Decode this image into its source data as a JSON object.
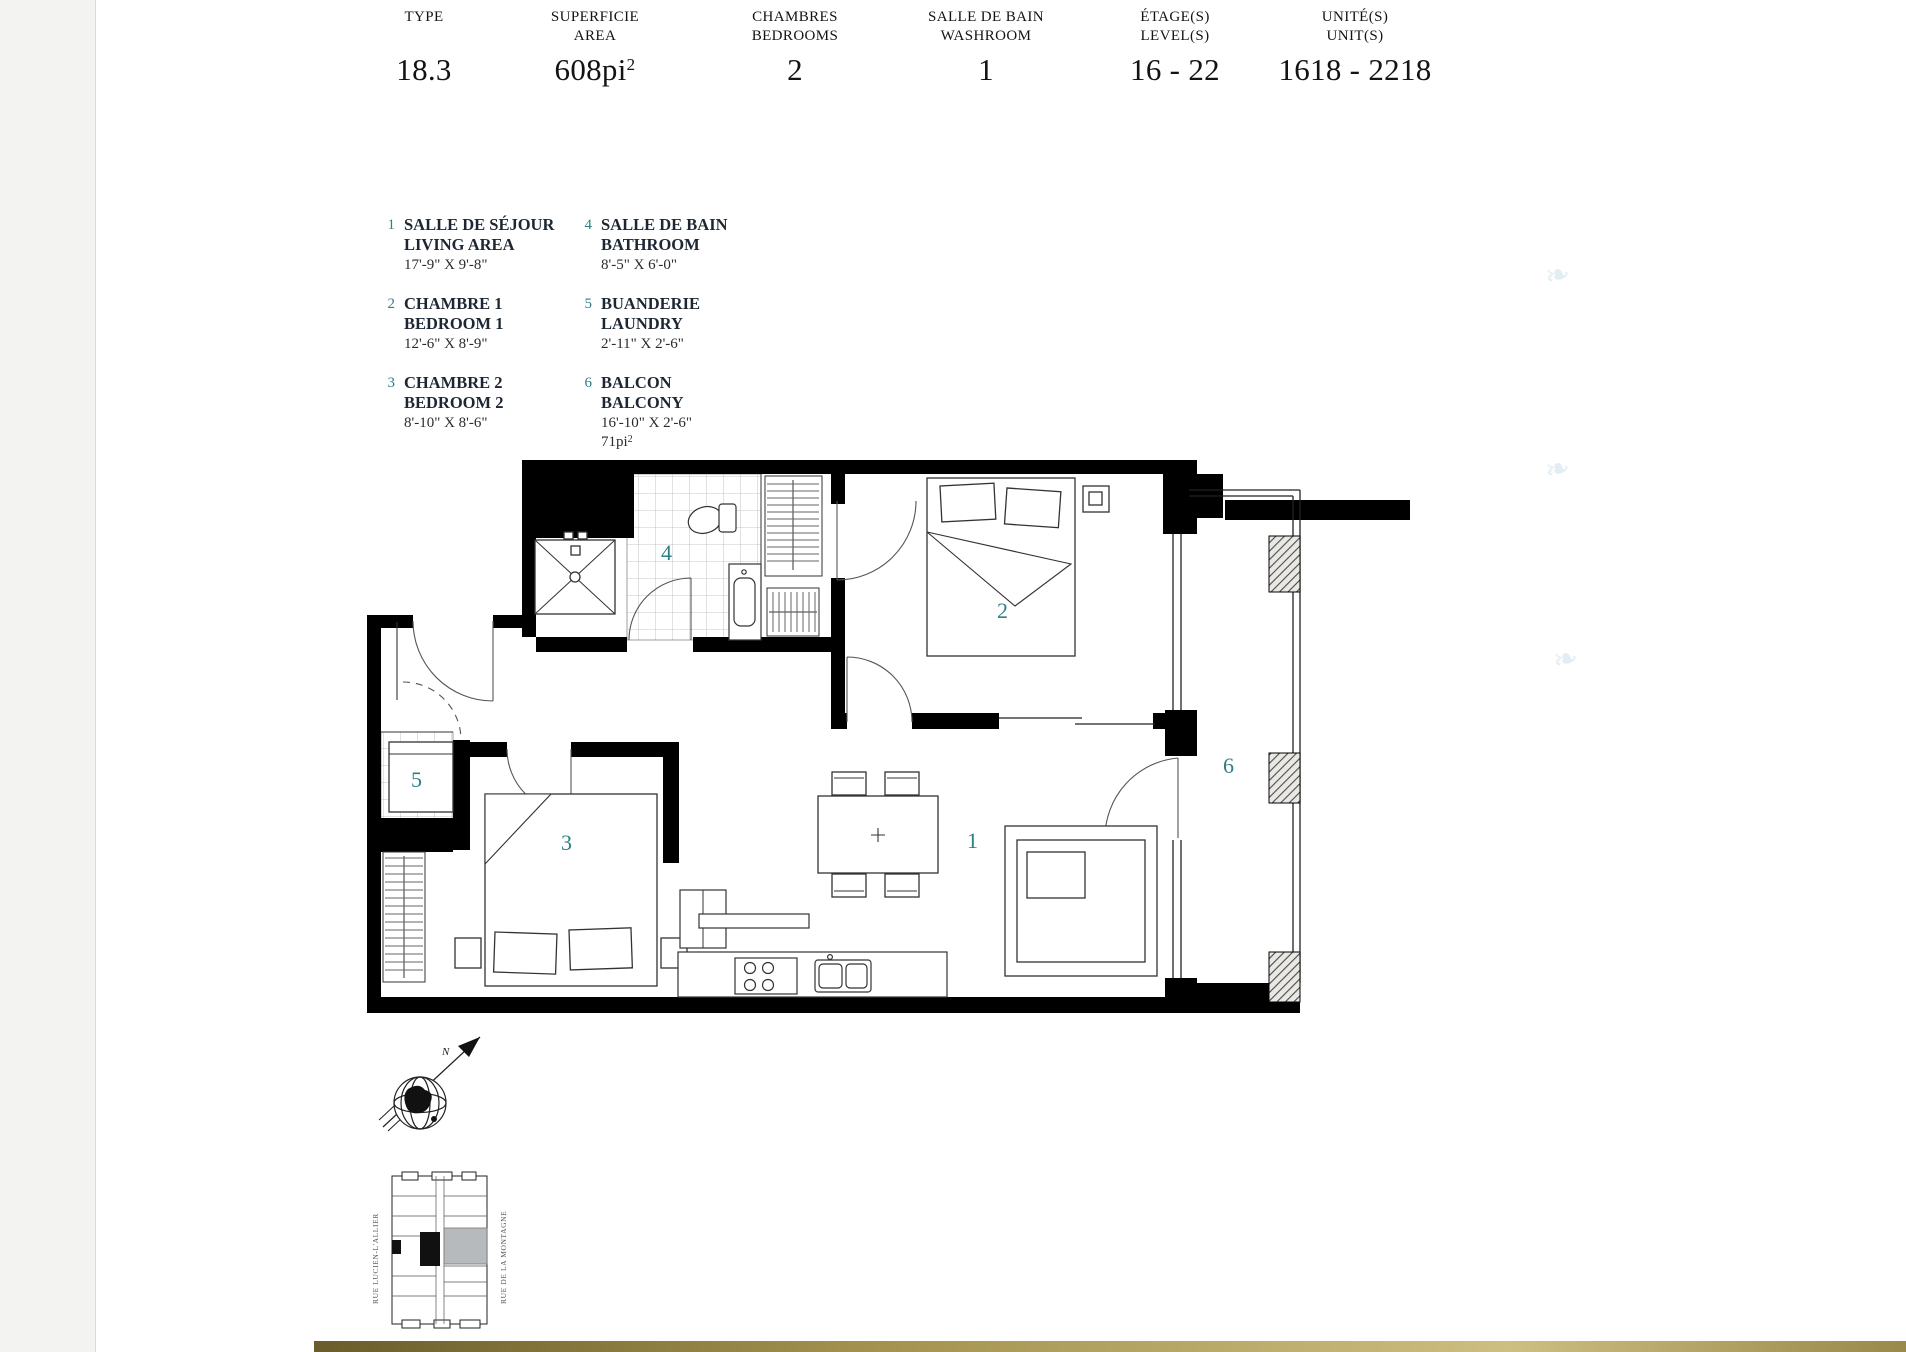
{
  "page": {
    "accent_teal": "#2e7f86",
    "gold_bar_color": "#a3924f",
    "watermark_glyph": "❧"
  },
  "header": {
    "columns": [
      {
        "label_line1": "TYPE",
        "label_line2": " ",
        "value": "18.3",
        "value_sup": ""
      },
      {
        "label_line1": "SUPERFICIE",
        "label_line2": "AREA",
        "value": "608pi",
        "value_sup": "2"
      },
      {
        "label_line1": "CHAMBRES",
        "label_line2": "BEDROOMS",
        "value": "2",
        "value_sup": ""
      },
      {
        "label_line1": "SALLE DE BAIN",
        "label_line2": "WASHROOM",
        "value": "1",
        "value_sup": ""
      },
      {
        "label_line1": "ÉTAGE(S)",
        "label_line2": "LEVEL(S)",
        "value": "16 - 22",
        "value_sup": ""
      },
      {
        "label_line1": "UNITÉ(S)",
        "label_line2": "UNIT(S)",
        "value": "1618 - 2218",
        "value_sup": ""
      }
    ]
  },
  "legend": {
    "items": [
      {
        "num": "1",
        "name_fr": "SALLE DE SÉJOUR",
        "name_en": "LIVING AREA",
        "dims": "17'-9\" X 9'-8\"",
        "area": "",
        "area_sup": ""
      },
      {
        "num": "2",
        "name_fr": "CHAMBRE 1",
        "name_en": "BEDROOM 1",
        "dims": "12'-6\" X 8'-9\"",
        "area": "",
        "area_sup": ""
      },
      {
        "num": "3",
        "name_fr": "CHAMBRE 2",
        "name_en": "BEDROOM 2",
        "dims": "8'-10\" X 8'-6\"",
        "area": "",
        "area_sup": ""
      },
      {
        "num": "4",
        "name_fr": "SALLE DE BAIN",
        "name_en": "BATHROOM",
        "dims": "8'-5\" X 6'-0\"",
        "area": "",
        "area_sup": ""
      },
      {
        "num": "5",
        "name_fr": "BUANDERIE",
        "name_en": "LAUNDRY",
        "dims": "2'-11\" X 2'-6\"",
        "area": "",
        "area_sup": ""
      },
      {
        "num": "6",
        "name_fr": "BALCON",
        "name_en": "BALCONY",
        "dims": "16'-10\" X 2'-6\"",
        "area": "71pi",
        "area_sup": "2"
      }
    ]
  },
  "plan": {
    "room_labels": {
      "living": "1",
      "bedroom1": "2",
      "bedroom2": "3",
      "bathroom": "4",
      "laundry": "5",
      "balcony": "6"
    }
  },
  "compass": {
    "north_label": "N"
  },
  "key_plan": {
    "street_left": "RUE LUCIEN-L'ALLIER",
    "street_right": "RUE DE LA MONTAGNE"
  }
}
